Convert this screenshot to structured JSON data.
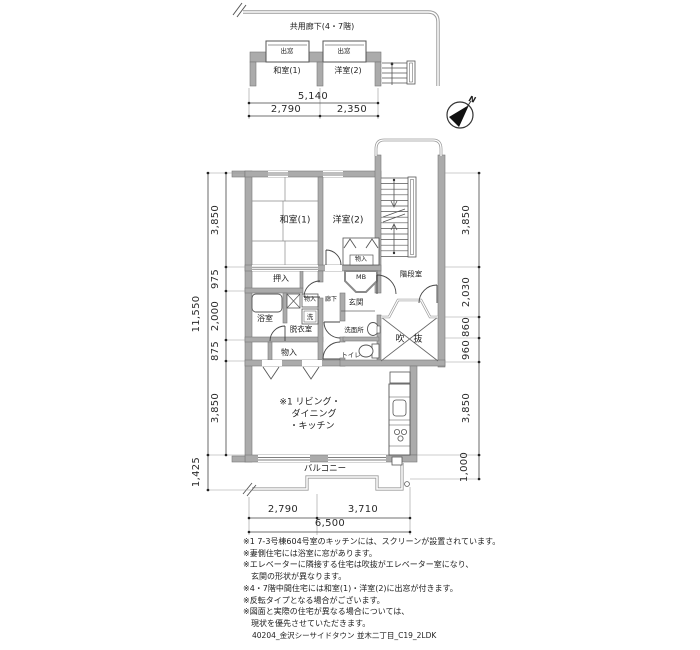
{
  "top_detail": {
    "corridor_label": "共用廊下(4・7階)",
    "bay_left": "出窓",
    "bay_right": "出窓",
    "room_left": "和室(1)",
    "room_right": "洋室(2)",
    "dim_total": "5,140",
    "dim_left": "2,790",
    "dim_right": "2,350"
  },
  "compass": {
    "label": "N"
  },
  "plan": {
    "washitsu1": "和室(1)",
    "yoshitsu2": "洋室(2)",
    "kaidanshitsu": "階段室",
    "oshiire": "押入",
    "monoire_bedroom2": "物入",
    "mb": "MB",
    "genkan": "玄関",
    "rouka": "廊下",
    "monoire_hall": "物入",
    "sentaku": "洗",
    "yokushitsu": "浴室",
    "datsuishitsu": "脱衣室",
    "senmenjo": "洗面所",
    "toilet": "トイレ",
    "fukinuke": "吹　抜",
    "monoire_lower": "物入",
    "ldk_line1": "※1 リビング・",
    "ldk_line2": "ダイニング",
    "ldk_line3": "・キッチン",
    "balcony": "バルコニー"
  },
  "dims": {
    "left_total": "11,550",
    "left_seg": [
      "3,850",
      "975",
      "2,000",
      "875",
      "3,850"
    ],
    "left_balcony": "1,425",
    "right_seg": [
      "3,850",
      "2,030",
      "860",
      "960",
      "3,850"
    ],
    "right_balcony": "1,000",
    "bottom_left": "2,790",
    "bottom_right": "3,710",
    "bottom_total": "6,500"
  },
  "notes": [
    "※1 7-3号棟604号室のキッチンには、スクリーンが設置されています。",
    "※妻側住宅には浴室に窓があります。",
    "※エレベーターに隣接する住宅は吹抜がエレベーター室になり、",
    "　玄関の形状が異なります。",
    "※4・7階中間住宅には和室(1)・洋室(2)に出窓が付きます。",
    "※反転タイプとなる場合がございます。",
    "※図面と実際の住宅が異なる場合については、",
    "　現状を優先させていただきます。"
  ],
  "footer": "40204_金沢シーサイドタウン 並木二丁目_C19_2LDK"
}
